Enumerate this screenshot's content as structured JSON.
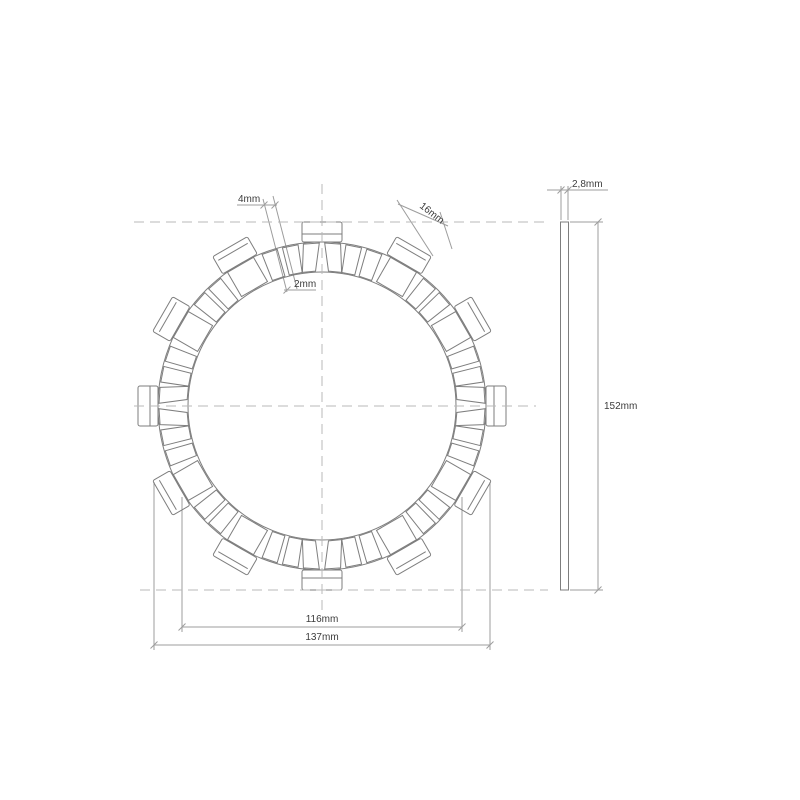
{
  "page": {
    "background": "#ffffff"
  },
  "drawing": {
    "type": "technical-drawing",
    "subject": "clutch friction disc plate, front view and side profile view",
    "colors": {
      "outline": "#7e7e7e",
      "centerline": "#b8b8b8",
      "dimension_line": "#9d9d9d",
      "label_text": "#3c3c3c",
      "background": "#ffffff"
    },
    "front_view": {
      "dimensions": {
        "slot_width": "4mm",
        "slot_gap": "2mm",
        "tab_width": "16mm",
        "pad_span": "116mm",
        "tab_span": "137mm"
      },
      "features": {
        "friction_pad_segments": 32,
        "large_drive_tabs": 8,
        "small_drive_tabs": 4
      }
    },
    "side_view": {
      "dimensions": {
        "thickness": "2,8mm",
        "overall_diameter": "152mm"
      }
    },
    "geometry": {
      "center_px": [
        322,
        406
      ],
      "scale_px_per_mm": 2.42,
      "pad_ring_outer_radius_px": 164,
      "pad_ring_inner_radius_px": 134,
      "tab_outer_radius_px": 184,
      "pad_slots": 48,
      "pad_slot_pitch_deg": 7.5,
      "pad_half_angle_deg": 2.8,
      "large_tab_angles_deg": [
        30,
        60,
        120,
        150,
        210,
        240,
        300,
        330
      ],
      "small_tab_angles_deg": [
        0,
        90,
        180,
        270
      ],
      "side_view_rect_px": [
        560.5,
        222,
        8,
        368
      ]
    }
  }
}
